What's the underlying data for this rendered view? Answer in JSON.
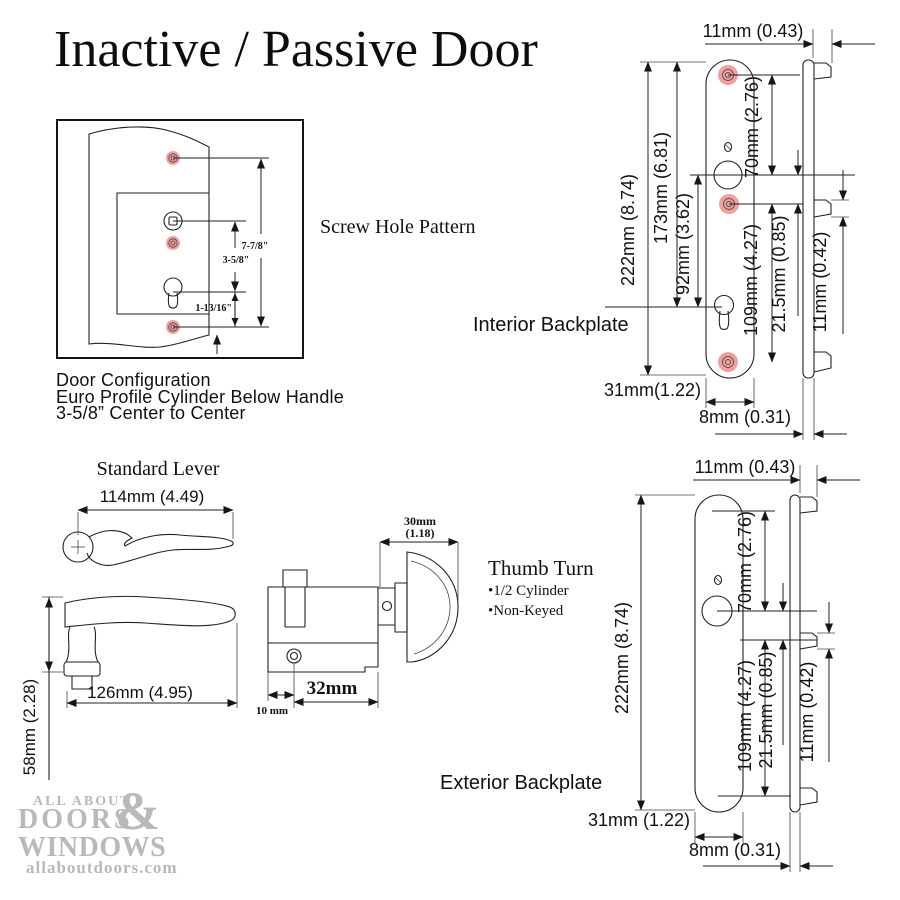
{
  "title": "Inactive / Passive Door",
  "screw_box": {
    "label": "Screw Hole Pattern",
    "dim_top_to_bottom": "7-7/8\"",
    "dim_center_to_center": "3-5/8\"",
    "dim_cyl_to_bottom": "1-13/16\""
  },
  "door_config": {
    "line1": "Door Configuration",
    "line2": "Euro Profile Cylinder Below Handle",
    "line3": "3-5/8” Center to Center"
  },
  "interior": {
    "label": "Interior Backplate",
    "top_width": "11mm (0.43)",
    "height": "222mm (8.74)",
    "screw_span": "173mm (6.81)",
    "spindle_to_cylinder": "92mm (3.62)",
    "top_to_spindle": "70mm (2.76)",
    "mid_to_bottom": "109mm (4.27)",
    "spindle_offset": "21.5mm (0.85)",
    "tab_height": "11mm (0.42)",
    "plate_width": "31mm(1.22)",
    "thickness": "8mm (0.31)"
  },
  "exterior": {
    "label": "Exterior Backplate",
    "top_width": "11mm (0.43)",
    "height": "222mm (8.74)",
    "top_to_spindle": "70mm (2.76)",
    "mid_to_bottom": "109mm (4.27)",
    "spindle_offset": "21.5mm (0.85)",
    "tab_height": "11mm (0.42)",
    "plate_width": "31mm (1.22)",
    "thickness": "8mm (0.31)"
  },
  "lever": {
    "label": "Standard Lever",
    "top_width": "114mm (4.49)",
    "side_width": "126mm (4.95)",
    "height": "58mm (2.28)"
  },
  "cylinder": {
    "thumb_width_line1": "30mm",
    "thumb_width_line2": "(1.18)",
    "length": "32mm",
    "screw_offset": "10 mm"
  },
  "thumb_turn": {
    "label": "Thumb Turn",
    "bullets": [
      "•1/2 Cylinder",
      "•Non-Keyed"
    ]
  },
  "logo": {
    "line1": "ALL ABOUT",
    "line2": "DOORS",
    "ampersand": "&",
    "line3": "WINDOWS",
    "website": "allaboutdoors.com"
  },
  "colors": {
    "line": "#222222",
    "screw_highlight": "#f29f9f",
    "screw_ring": "#8a8a8a",
    "logo_gray": "#b9b9b9"
  }
}
